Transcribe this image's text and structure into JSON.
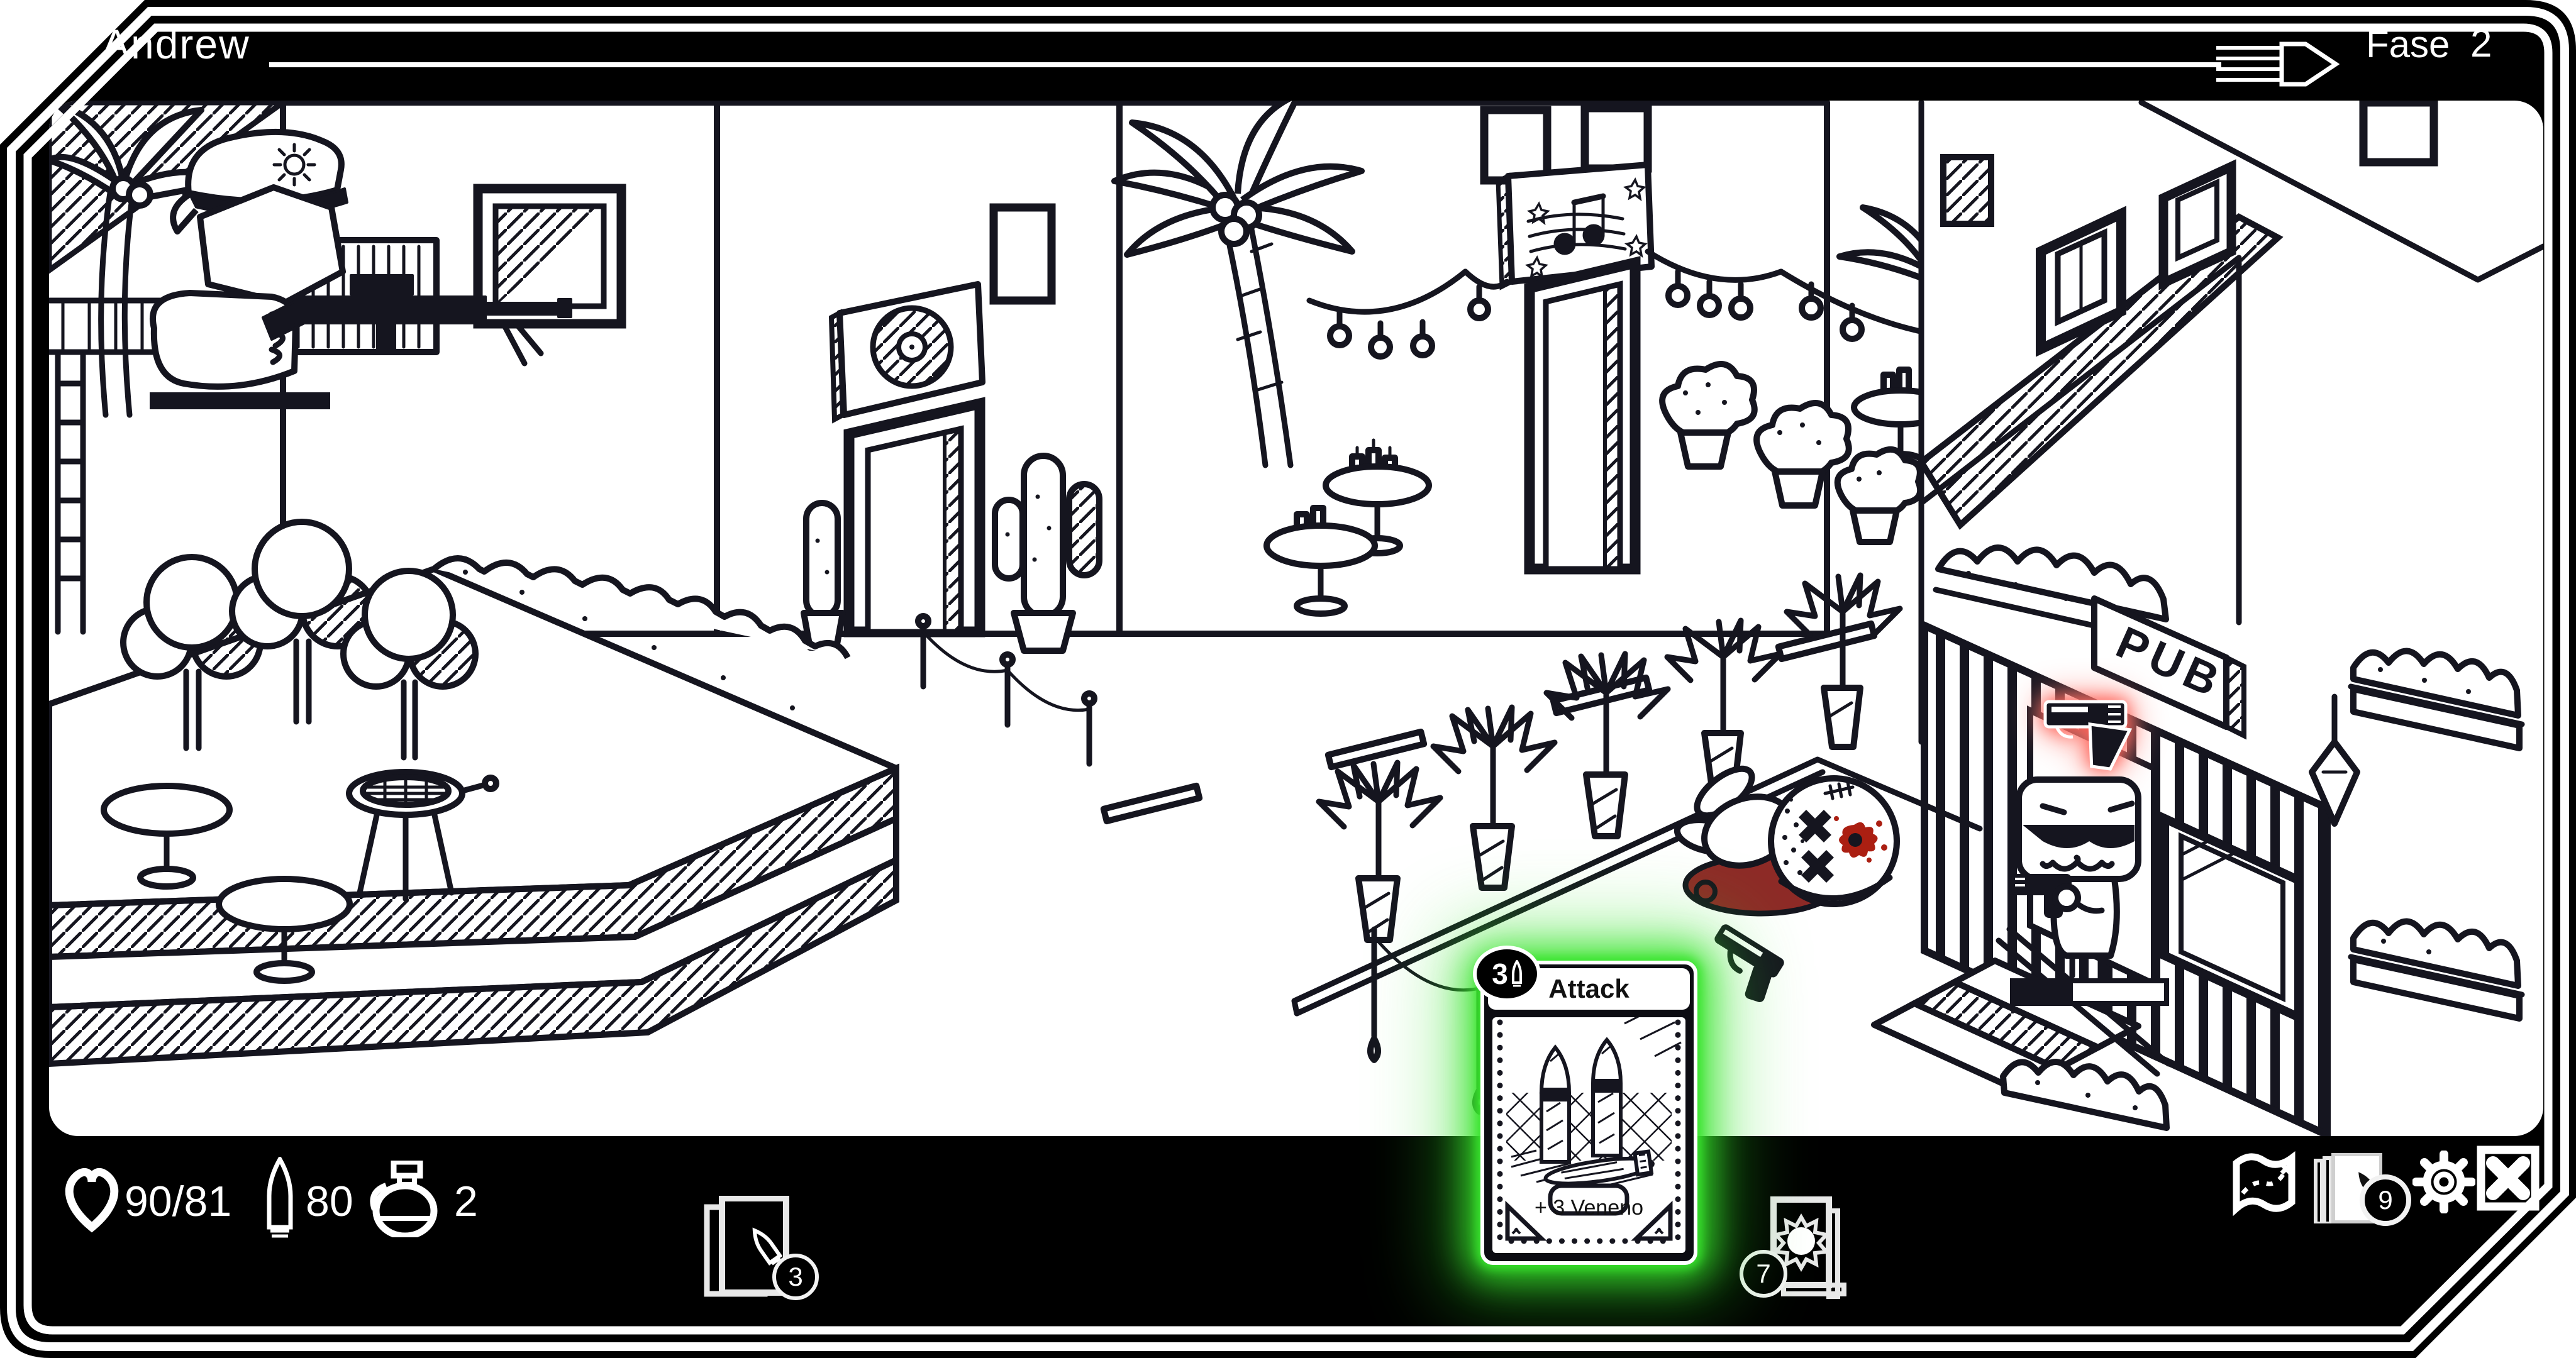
{
  "topbar": {
    "player": "Andrew",
    "phase_label": "Fase",
    "phase_value": "2"
  },
  "stats": {
    "hp": "90/81",
    "ammo": "80",
    "grenades": "2"
  },
  "piles": {
    "draw": "3",
    "discard": "7"
  },
  "hand": {
    "count": "9"
  },
  "card": {
    "cost": "3",
    "title": "Attack",
    "effect": "+ 3 Veneno"
  },
  "scene": {
    "pub_sign": "PUB"
  },
  "colors": {
    "ink": "#15151f",
    "card_glow": "#38e42d",
    "alert_glow": "#ff5a50",
    "blood": "#8e2a27",
    "blood_bright": "#ab1f12"
  }
}
